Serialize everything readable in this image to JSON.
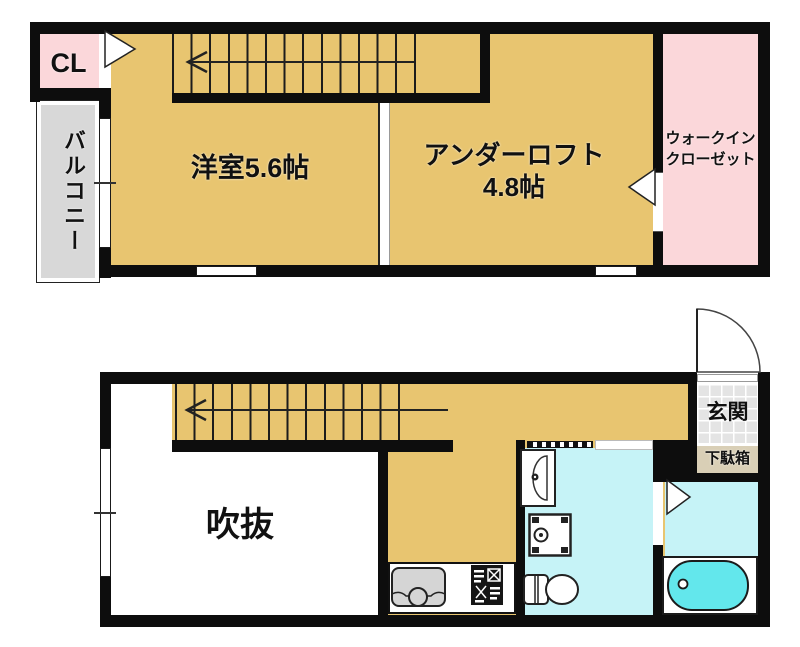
{
  "plan": {
    "floor2": {
      "closet": "CL",
      "balcony": "バルコニー",
      "bedroom": "洋室5.6帖",
      "loft_line1": "アンダーロフト",
      "loft_line2": "4.8帖",
      "wic_line1": "ウォークイン",
      "wic_line2": "クローゼット"
    },
    "floor1": {
      "void": "吹抜",
      "entrance": "玄関",
      "shoe_cabinet": "下駄箱"
    },
    "colors": {
      "floor": "#e8c570",
      "closet_pink": "#fbd7da",
      "balcony_gray": "#d8d8d8",
      "entrance_tile": "#e4e4e4",
      "shoe_cabinet_beige": "#d9cfb6",
      "sanitary_cyan": "#c6f3f7",
      "bathtub_cyan": "#63e7ec",
      "wall": "#0d0d0d"
    }
  }
}
